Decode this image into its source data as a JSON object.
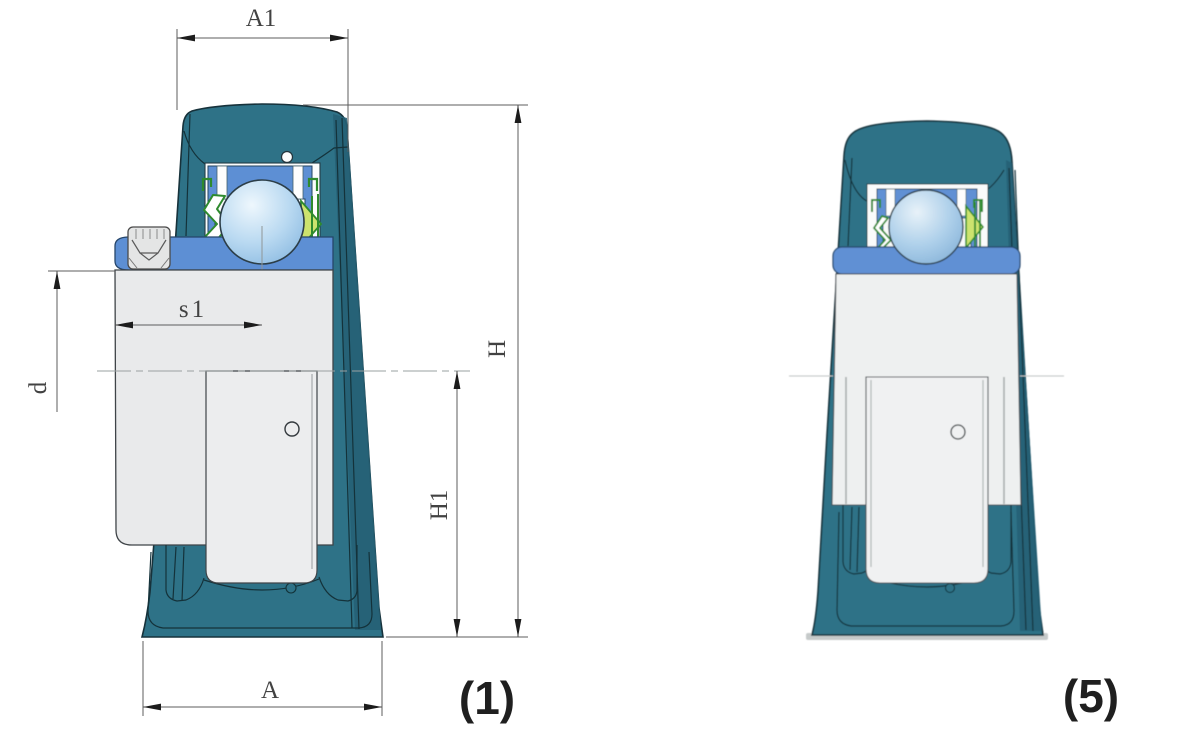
{
  "page": {
    "background": "#ffffff",
    "description": "Technical drawing: hanger bearing unit, two sectioned front views"
  },
  "views": {
    "left": {
      "caption": "(1)"
    },
    "right": {
      "caption": "(5)"
    }
  },
  "dimensions": {
    "a1": "A1",
    "h": "H",
    "h1": "H1",
    "a": "A",
    "s1": "s1",
    "d": "d"
  },
  "colors": {
    "housing": "#2e7287",
    "housing_dark": "#266176",
    "ring_blue": "#5d8fd4",
    "ring_blue_right": "#6090d4",
    "seal_green": "#2e8a2e",
    "seal_lime": "#cde36e",
    "shaft_gray": "#e9eaeb",
    "sleeve_gray": "#ecedee",
    "cavity_white": "#fcfdfd",
    "ball_highlight": "#eef7fd",
    "ball_shade": "#7fb2dd",
    "outline": "#17323b",
    "dimension_line": "#5c5c5c",
    "label_text": "#424242",
    "caption_text": "#1f1f1f"
  }
}
